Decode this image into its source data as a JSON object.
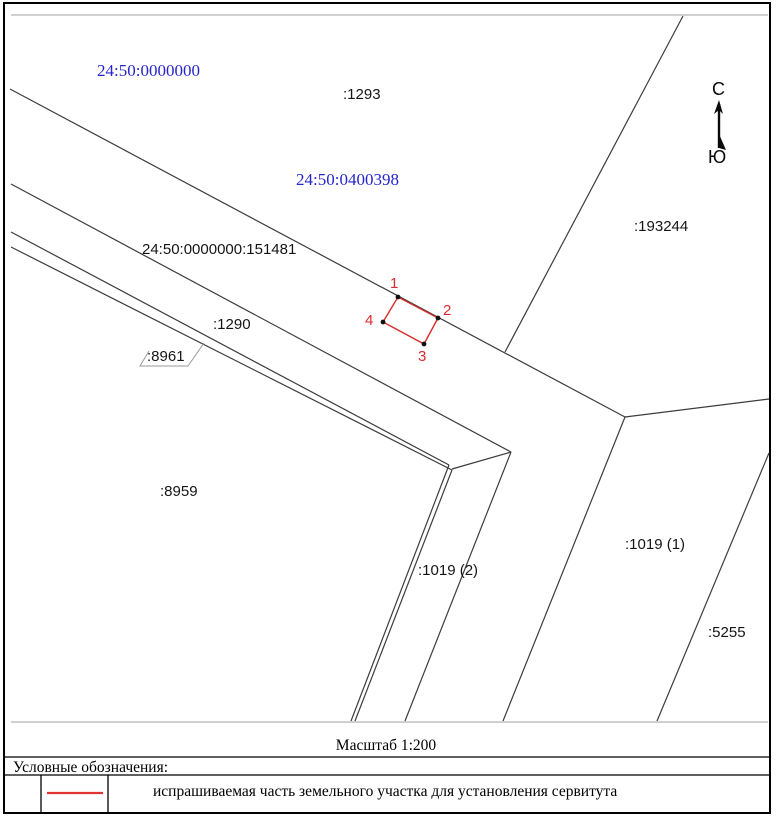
{
  "cadastral_quarters": {
    "main": "24:50:0000000",
    "q0400398": "24:50:0400398"
  },
  "parcels": {
    "p1293": ":1293",
    "p193244": ":193244",
    "p151481": "24:50:0000000:151481",
    "p1290": ":1290",
    "p8961": ":8961",
    "p8959": ":8959",
    "p1019_2": ":1019 (2)",
    "p1019_1": ":1019 (1)",
    "p5255": ":5255"
  },
  "servitude_points": {
    "p1": "1",
    "p2": "2",
    "p3": "3",
    "p4": "4"
  },
  "compass": {
    "north": "С",
    "south": "Ю"
  },
  "footer": {
    "scale": "Масштаб 1:200"
  },
  "legend": {
    "title": "Условные обозначения:",
    "item_label": "испрашиваемая часть земельного участка для установления сервитута",
    "item_symbol": "red-line"
  },
  "colors": {
    "boundary_line": "#3c3c3c",
    "quarter_text": "#2424cd",
    "servitude_red": "#d92b2b",
    "rule_gray": "#c0c0c0"
  }
}
